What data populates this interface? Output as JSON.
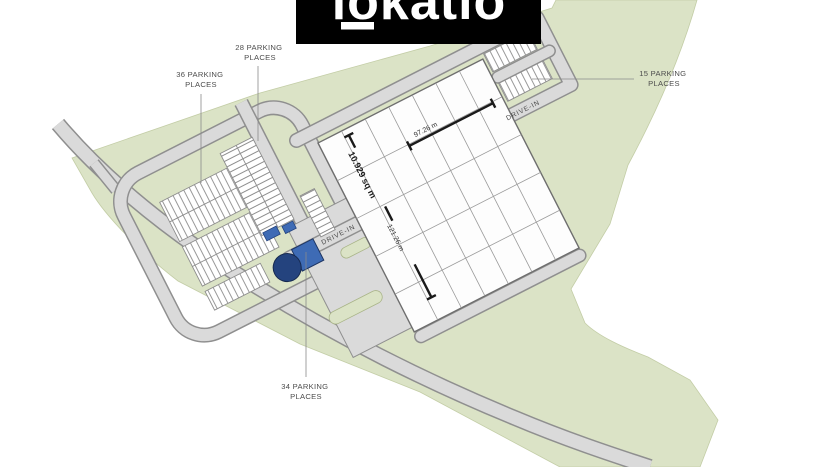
{
  "logo": {
    "text": "lokatio"
  },
  "plan": {
    "labels": {
      "p36_1": "36 PARKING",
      "p36_2": "PLACES",
      "p28_1": "28 PARKING",
      "p28_2": "PLACES",
      "p15_1": "15 PARKING",
      "p15_2": "PLACES",
      "p34_1": "34 PARKING",
      "p34_2": "PLACES"
    },
    "building": {
      "area": "10.929 sq m",
      "width": "97.26 m",
      "length": "121.26 m",
      "drive_in_nw": "DRIVE-IN",
      "drive_in_sw": "DRIVE-IN"
    },
    "colors": {
      "landscape_green": "#dbe3c6",
      "road_fill": "#dadada",
      "road_edge": "#8f8f8f",
      "water_tank_dark": "#24437e",
      "structure_blue": "#3e6bb5",
      "logo_bg": "#000000",
      "logo_fg": "#ffffff"
    }
  }
}
